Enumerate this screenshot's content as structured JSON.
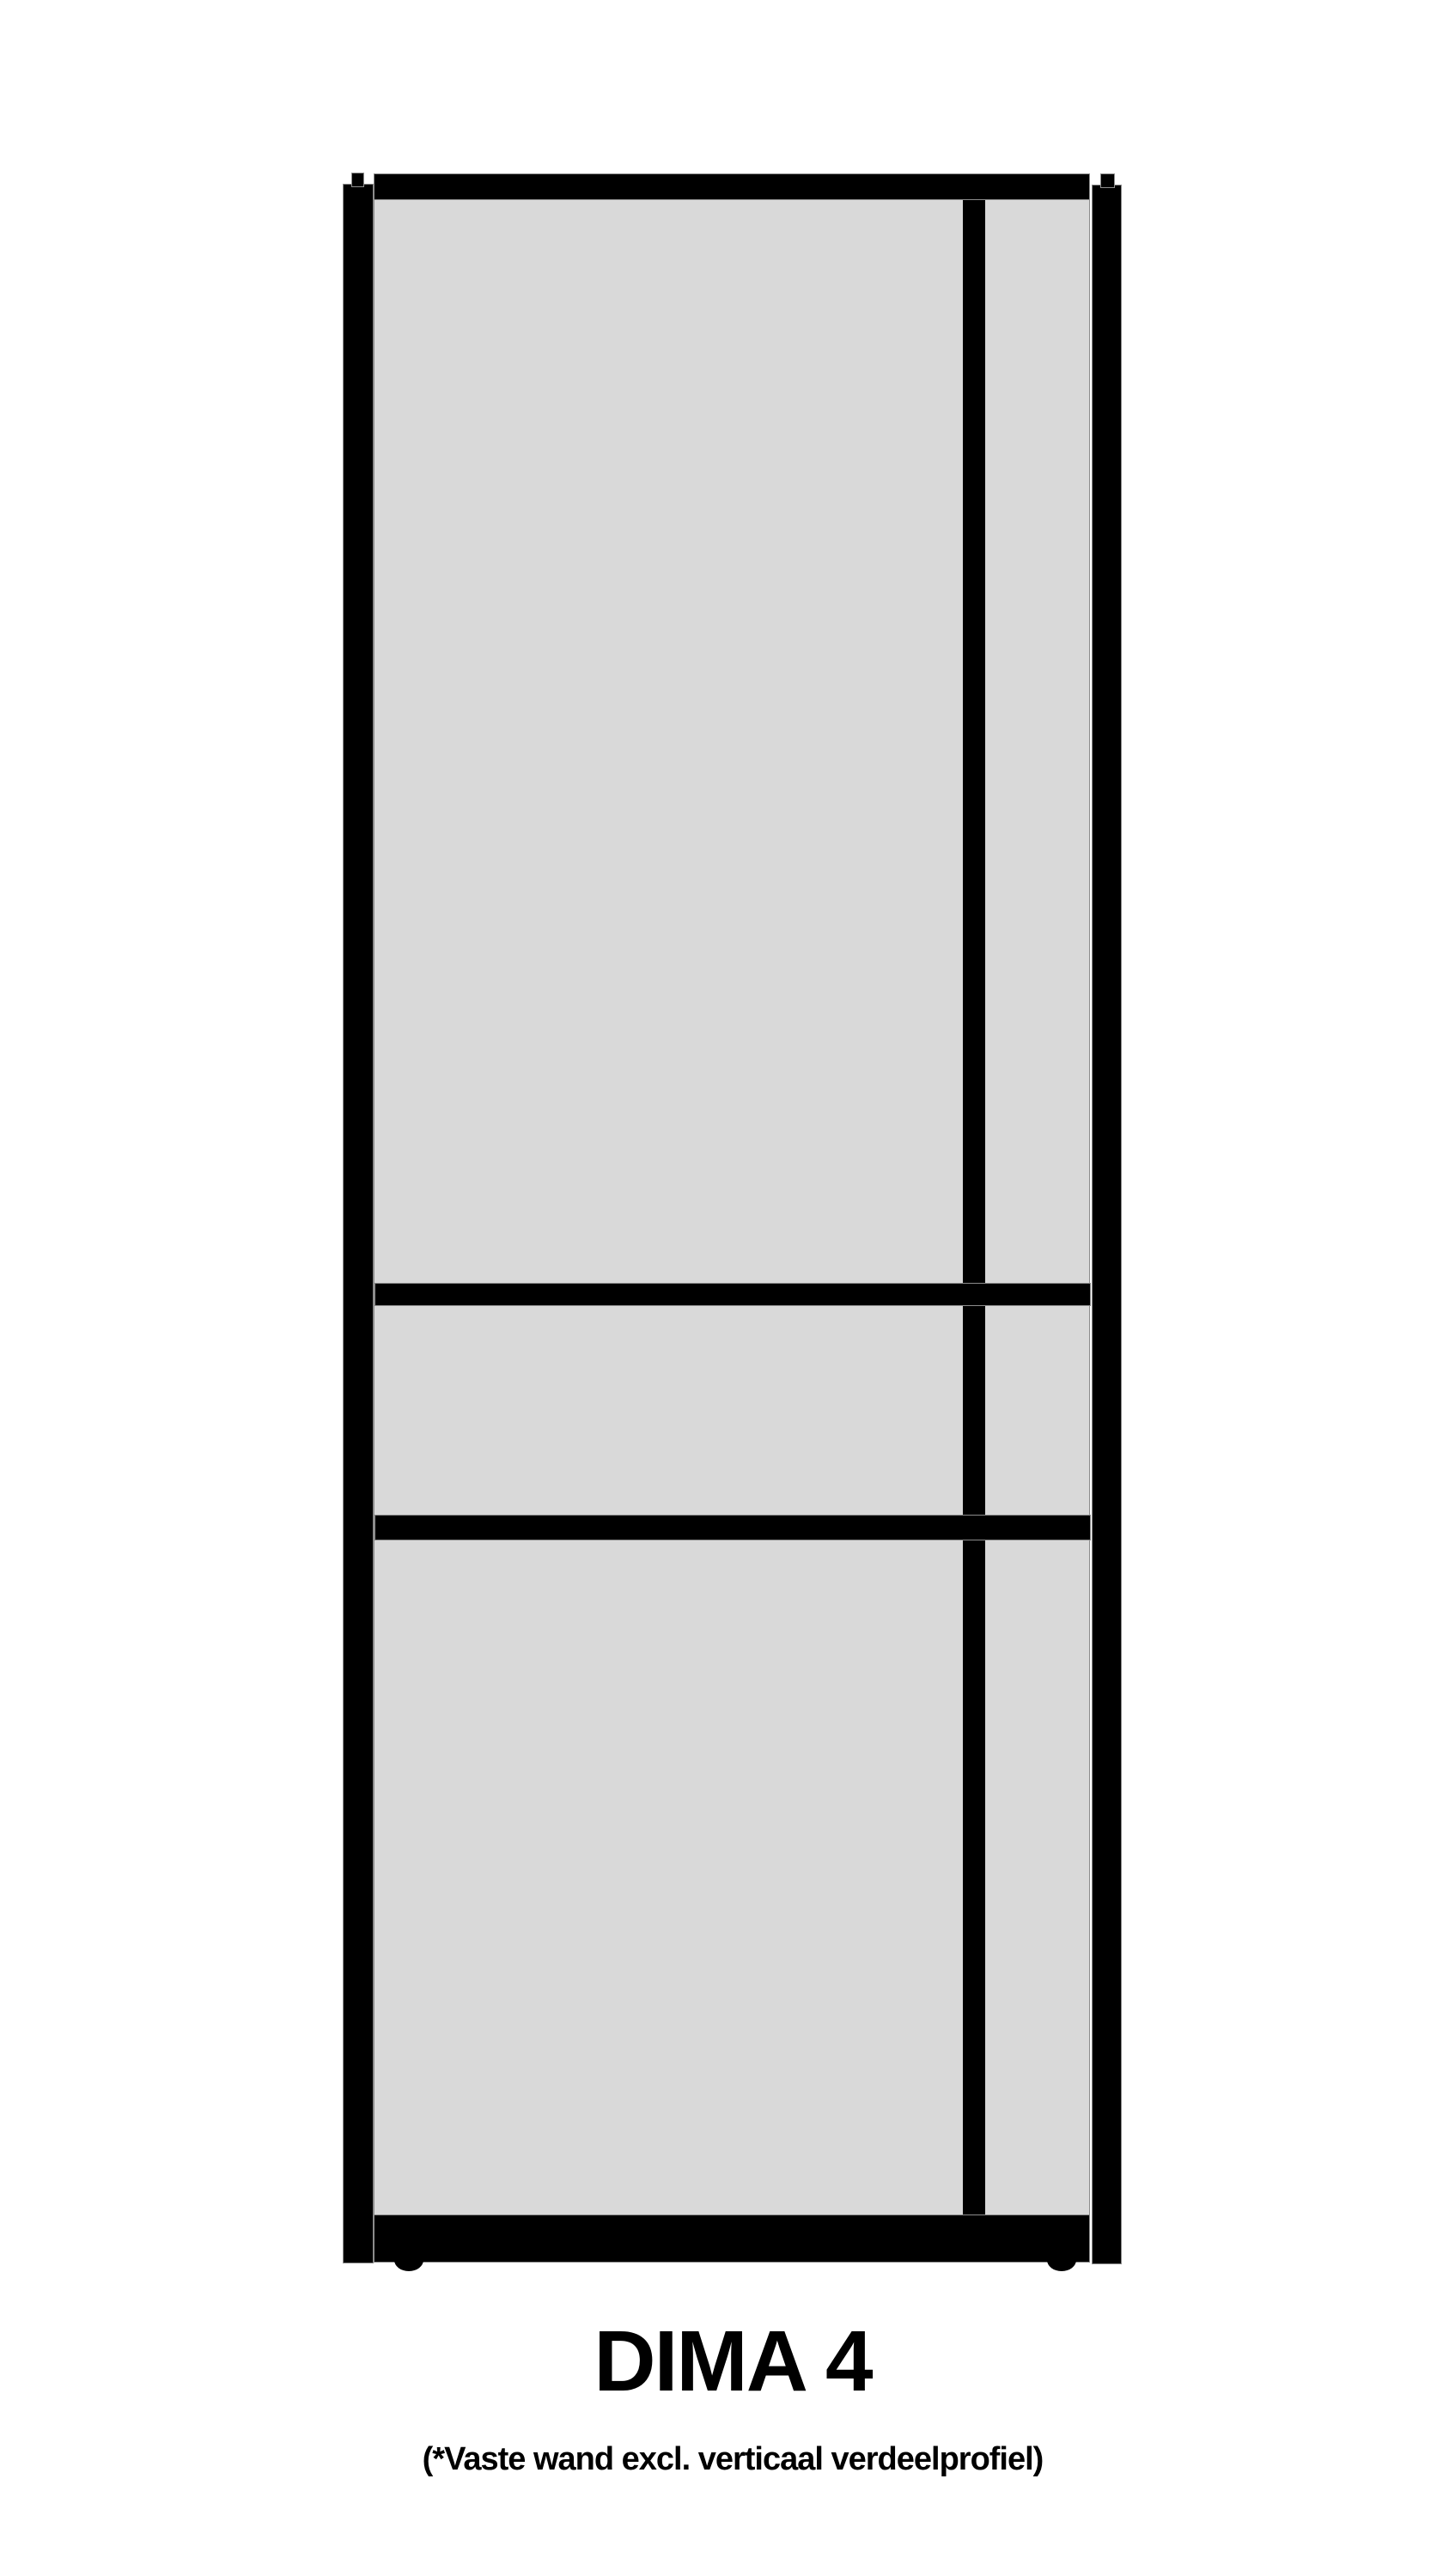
{
  "figure": {
    "title": "DIMA 4",
    "subtitle": "(*Vaste wand excl. verticaal verdeelprofiel)"
  },
  "colors": {
    "background": "#ffffff",
    "frame": "#000000",
    "glass": "#d9d9d9",
    "glass_edge": "#8c8c8c"
  }
}
